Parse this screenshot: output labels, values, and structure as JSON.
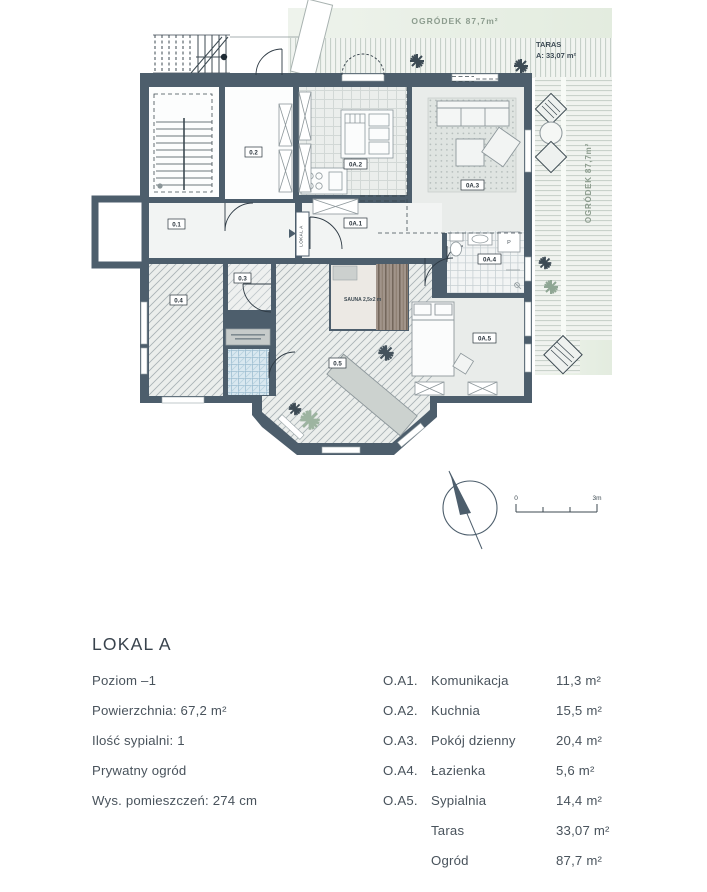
{
  "plan": {
    "garden_top_label": "OGRÓDEK  87,7m²",
    "garden_right_label": "OGRÓDEK 87,7m²",
    "terrace_label_line1": "TARAS",
    "terrace_label_line2": "A: 33,07 m²",
    "sauna_label": "SAUNA 2,5x2 m",
    "entrance_label": "LOKAL A",
    "washer_label": "P",
    "rooms": {
      "r01": "0.1",
      "r02": "0.2",
      "r03": "0.3",
      "r04": "0.4",
      "r05": "0.5",
      "ra1": "0A.1",
      "ra2": "0A.2",
      "ra3": "0A.3",
      "ra4": "0A.4",
      "ra5": "0A.5"
    },
    "scale_start": "0",
    "scale_end": "3m"
  },
  "details": {
    "title": "LOKAL A",
    "specs": [
      "Poziom –1",
      "Powierzchnia: 67,2 m²",
      "Ilość sypialni: 1",
      "Prywatny ogród",
      "Wys. pomieszczeń: 274 cm"
    ],
    "rooms": [
      {
        "code": "O.A1.",
        "name": "Komunikacja",
        "area": "11,3 m²"
      },
      {
        "code": "O.A2.",
        "name": "Kuchnia",
        "area": "15,5 m²"
      },
      {
        "code": "O.A3.",
        "name": "Pokój dzienny",
        "area": "20,4 m²"
      },
      {
        "code": "O.A4.",
        "name": "Łazienka",
        "area": "5,6 m²"
      },
      {
        "code": "O.A5.",
        "name": "Sypialnia",
        "area": "14,4 m²"
      },
      {
        "code": "",
        "name": "Taras",
        "area": "33,07 m²"
      },
      {
        "code": "",
        "name": "Ogród",
        "area": "87,7 m²"
      }
    ]
  },
  "colors": {
    "wall": "#4d5e6c",
    "garden_green": "#edf2ea",
    "label_green": "#8c9c8e",
    "text_dark": "#333f49",
    "blue_tile": "#d9e8f0"
  }
}
